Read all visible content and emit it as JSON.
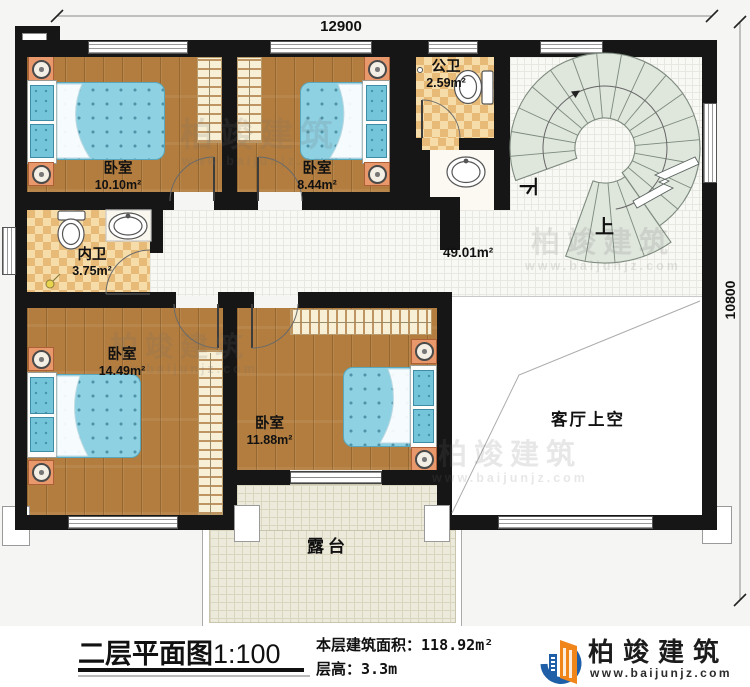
{
  "dimensions": {
    "top": "12900",
    "right": "10800"
  },
  "rooms": {
    "bedroom_top_left": {
      "name": "卧室",
      "area": "10.10m²"
    },
    "bedroom_top_mid": {
      "name": "卧室",
      "area": "8.44m²"
    },
    "public_bath": {
      "name": "公卫",
      "area": "2.59m²"
    },
    "inner_bath": {
      "name": "内卫",
      "area": "3.75m²"
    },
    "bedroom_bottom_left": {
      "name": "卧室",
      "area": "14.49m²"
    },
    "bedroom_bottom_mid": {
      "name": "卧室",
      "area": "11.88m²"
    },
    "hall": {
      "area": "49.01m²"
    },
    "terrace": {
      "name": "露台"
    },
    "living_void": {
      "name": "客厅上空"
    },
    "stairs": {
      "down": "下",
      "up": "上"
    }
  },
  "footer": {
    "title": "二层平面图",
    "scale": "1:100",
    "area_label": "本层建筑面积：",
    "area_value": "118.92m²",
    "height_label": "层高：",
    "height_value": "3.3m"
  },
  "logo": {
    "name": "柏竣建筑",
    "url": "www.baijunjz.com"
  },
  "watermark": {
    "name": "柏竣建筑",
    "url": "www.baijunjz.com"
  },
  "colors": {
    "wall": "#161616",
    "wood": "#b27d3f",
    "bath_tile": "#eec88b",
    "hall_tile": "#f8f8f4",
    "terrace_tile": "#eceadb",
    "stair": "#dfe6dc",
    "bed": "#8ed1e2",
    "nightstand": "#e8986a",
    "logo_blue": "#1f5fa8",
    "logo_orange": "#f08519"
  }
}
